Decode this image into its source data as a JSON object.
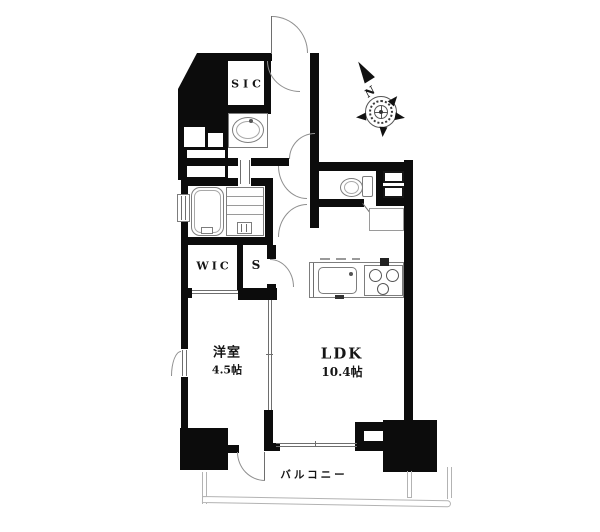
{
  "floorplan": {
    "rooms": [
      {
        "name": "shoe-in-closet",
        "label": "SIC"
      },
      {
        "name": "walk-in-closet",
        "label": "WIC"
      },
      {
        "name": "storage",
        "label": "S"
      },
      {
        "name": "bedroom",
        "label": "洋室",
        "size": "4.5帖"
      },
      {
        "name": "living-dining-kitchen",
        "label": "LDK",
        "size": "10.4帖"
      },
      {
        "name": "balcony",
        "label": "バルコニー"
      }
    ],
    "compass": {
      "north_label": "N"
    },
    "fixtures": [
      "entrance-door",
      "washbasin",
      "bathtub",
      "shower-room",
      "toilet",
      "kitchen-sink",
      "gas-stove",
      "refrigerator-space",
      "shelf",
      "compass-rose"
    ],
    "colors": {
      "wall": "#0c0c0c",
      "thin_line": "#6e6e6e",
      "balcony_line": "#b3b3b3",
      "background": "#ffffff"
    }
  }
}
